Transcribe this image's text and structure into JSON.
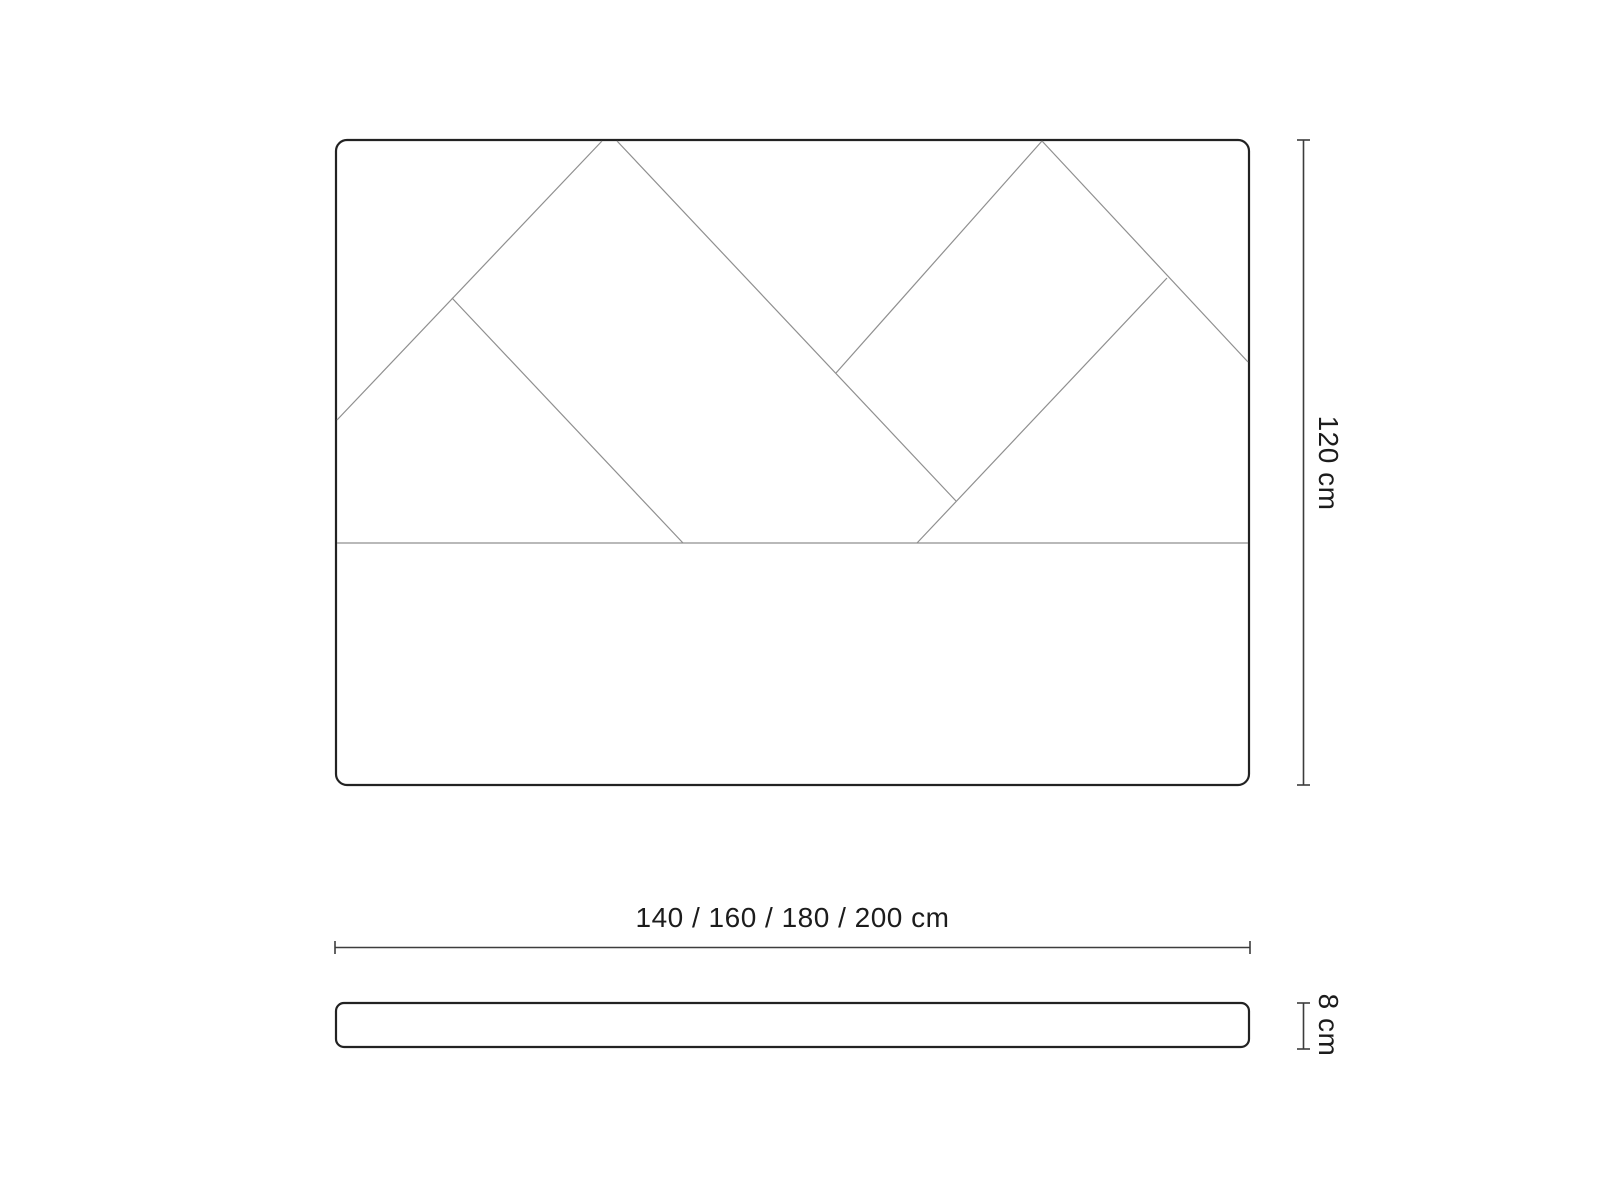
{
  "diagram": {
    "kind": "headboard-dimension-drawing",
    "front_view": {
      "height_dimension": "120 cm",
      "width_dimension": "140 / 160 / 180 / 200 cm"
    },
    "side_view": {
      "thickness_dimension": "8 cm"
    },
    "colors": {
      "outline": "#222222",
      "pattern_line": "#8f8f8f",
      "dimension_line": "#3d3d3d",
      "background": "#ffffff",
      "text": "#1c1c1c"
    }
  }
}
